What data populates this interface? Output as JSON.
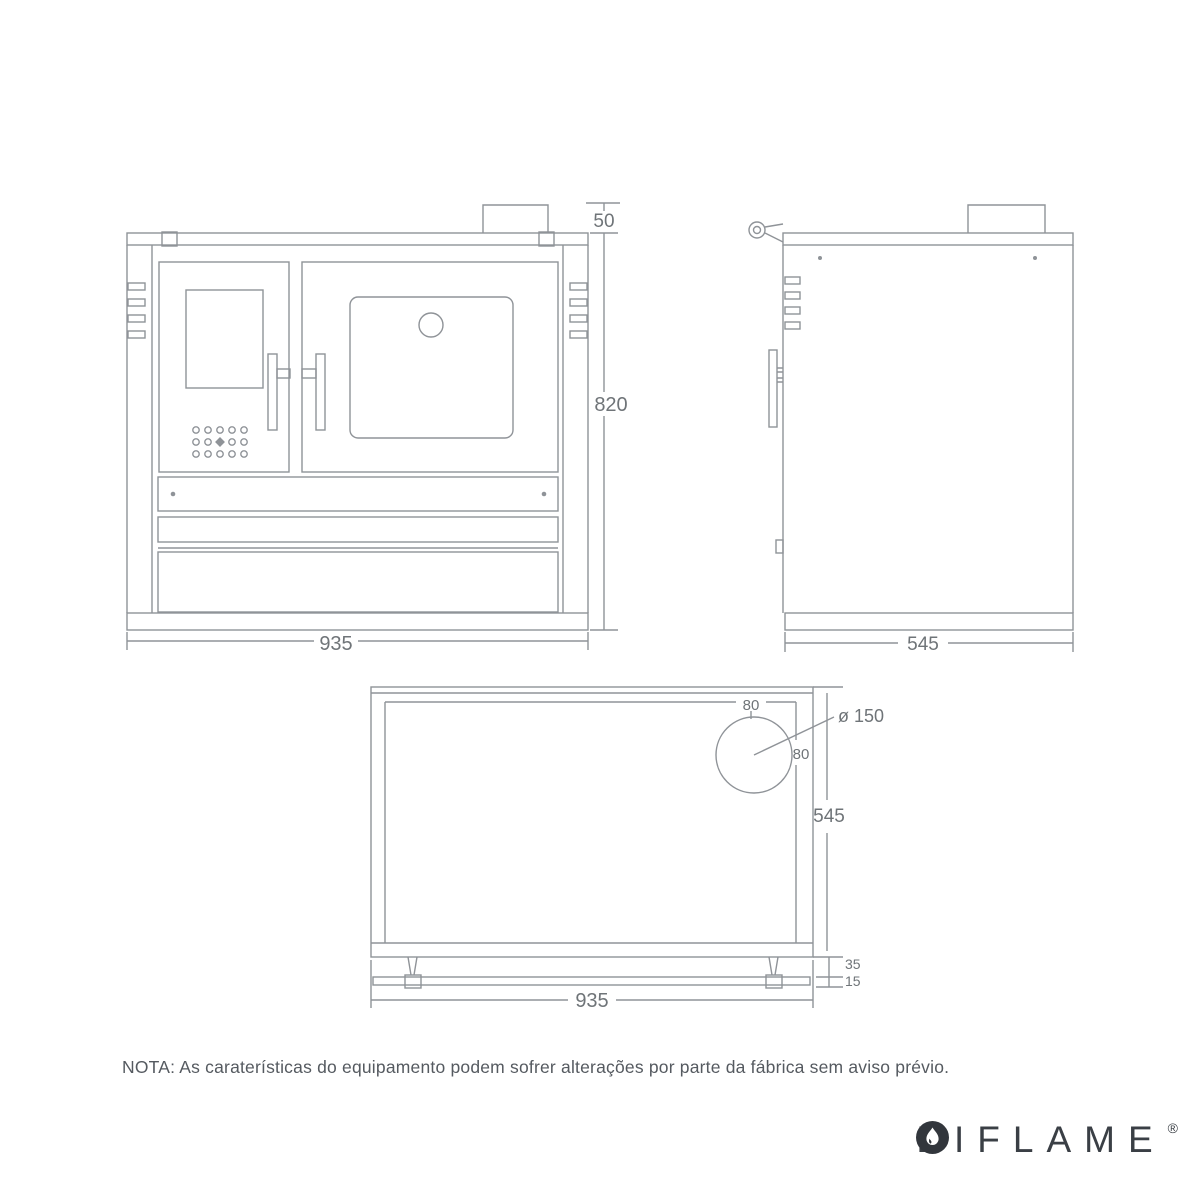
{
  "note": {
    "text": "NOTA: As caraterísticas do equipamento podem sofrer alterações por parte da fábrica sem aviso prévio."
  },
  "brand": {
    "letters_before": [
      "B",
      "I"
    ],
    "letters_after": [
      "F",
      "L",
      "A",
      "M",
      "E"
    ],
    "registered": "®",
    "flame_icon": "flame-in-circle",
    "color": "#3a3f45"
  },
  "dimensions": {
    "front": {
      "flue_height": "50",
      "height": "820",
      "width": "935"
    },
    "side": {
      "depth": "545"
    },
    "top": {
      "offset_rear": "80",
      "flue_diameter": "ø 150",
      "offset_side": "80",
      "depth": "545",
      "rail_gap": "35",
      "rail_bar": "15",
      "width": "935"
    }
  },
  "colors": {
    "line": "#8f9398",
    "dim_text": "#6f7478",
    "note_text": "#555a60",
    "brand_text": "#3a3f45"
  }
}
